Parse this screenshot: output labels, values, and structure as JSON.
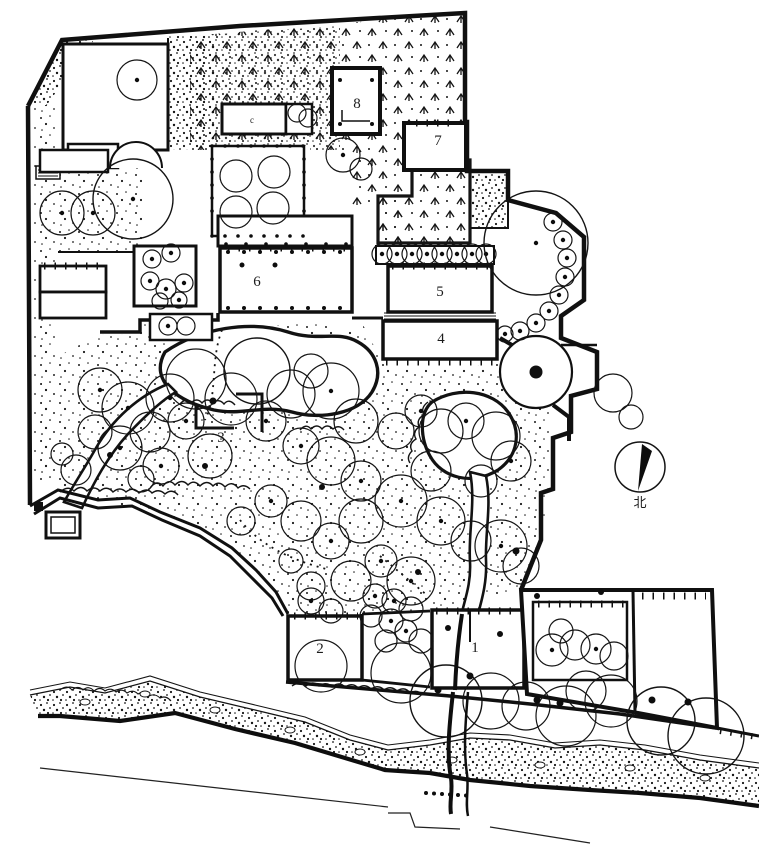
{
  "colors": {
    "ink": "#151515",
    "paper": "#ffffff"
  },
  "labels": {
    "area1": "1",
    "area2": "2",
    "area3": "3",
    "area4": "4",
    "area5": "5",
    "area6": "6",
    "area7": "7",
    "area8": "8",
    "annex_mark": "c",
    "compass_north": "北"
  }
}
